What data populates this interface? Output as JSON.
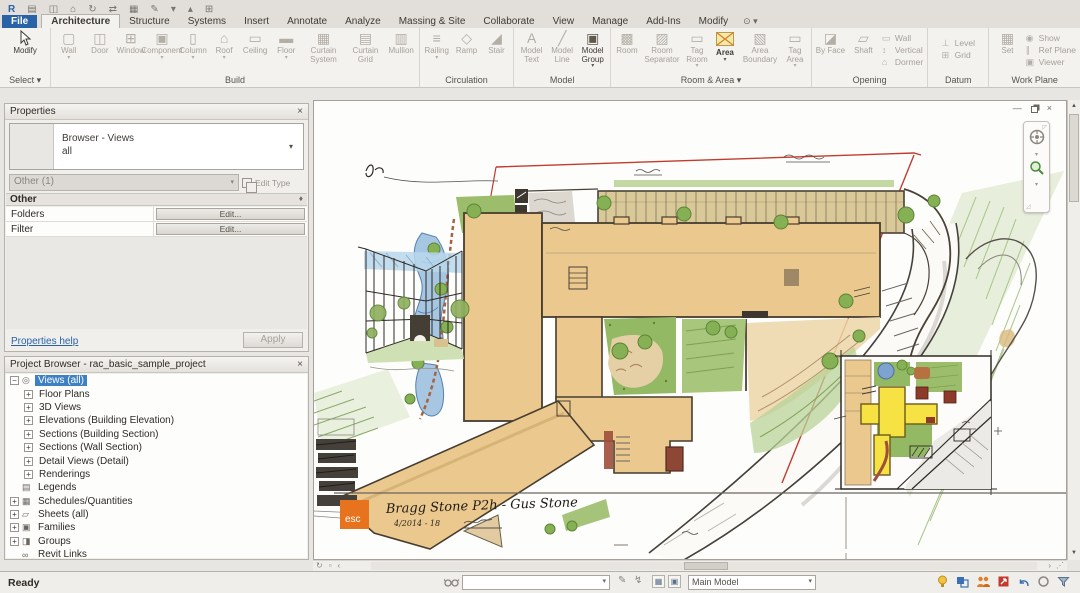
{
  "qat": {
    "glyphs": [
      "R",
      "▤",
      "◫",
      "⌂",
      "↻",
      "⇄",
      "▦",
      "✎",
      "▾",
      "▴",
      "⊞"
    ]
  },
  "tabs": {
    "items": [
      "File",
      "Architecture",
      "Structure",
      "Systems",
      "Insert",
      "Annotate",
      "Analyze",
      "Massing & Site",
      "Collaborate",
      "View",
      "Manage",
      "Add-Ins",
      "Modify"
    ],
    "modify_menu_icon": "⊙ ▾"
  },
  "ribbon": {
    "panels": [
      {
        "label": "Select ▾",
        "buttons": [
          {
            "label": "Modify",
            "enabled": true
          }
        ]
      },
      {
        "label": "Build",
        "buttons": [
          {
            "label": "Wall",
            "glyph": "▢",
            "arrow": "▾"
          },
          {
            "label": "Door",
            "glyph": "◫"
          },
          {
            "label": "Window",
            "glyph": "⊞"
          },
          {
            "label": "Component",
            "glyph": "▣",
            "arrow": "▾"
          },
          {
            "label": "Column",
            "glyph": "▯",
            "arrow": "▾"
          },
          {
            "label": "Roof",
            "glyph": "⌂",
            "arrow": "▾"
          },
          {
            "label": "Ceiling",
            "glyph": "▭"
          },
          {
            "label": "Floor",
            "glyph": "▬",
            "arrow": "▾"
          },
          {
            "label": "Curtain System",
            "glyph": "▦"
          },
          {
            "label": "Curtain Grid",
            "glyph": "▤"
          },
          {
            "label": "Mullion",
            "glyph": "▥"
          }
        ]
      },
      {
        "label": "Circulation",
        "buttons": [
          {
            "label": "Railing",
            "glyph": "≡",
            "arrow": "▾"
          },
          {
            "label": "Ramp",
            "glyph": "◇"
          },
          {
            "label": "Stair",
            "glyph": "◢"
          }
        ]
      },
      {
        "label": "Model",
        "buttons": [
          {
            "label": "Model Text",
            "glyph": "A"
          },
          {
            "label": "Model Line",
            "glyph": "╱"
          },
          {
            "label": "Model Group",
            "glyph": "▣",
            "arrow": "▾",
            "enabled": true
          }
        ]
      },
      {
        "label": "Room & Area ▾",
        "buttons": [
          {
            "label": "Room",
            "glyph": "▩"
          },
          {
            "label": "Room Separator",
            "glyph": "▨"
          },
          {
            "label": "Tag Room",
            "glyph": "▭",
            "arrow": "▾"
          },
          {
            "label": "Area",
            "glyph": "area",
            "arrow": "▾",
            "enabled": true,
            "highlight": true
          },
          {
            "label": "Area Boundary",
            "glyph": "▧"
          },
          {
            "label": "Tag Area",
            "glyph": "▭",
            "arrow": "▾"
          }
        ]
      },
      {
        "label": "Opening",
        "buttons": [
          {
            "label": "By Face",
            "glyph": "◪"
          },
          {
            "label": "Shaft",
            "glyph": "▱"
          }
        ],
        "small_buttons": [
          {
            "label": "Wall",
            "glyph": "▭"
          },
          {
            "label": "Vertical",
            "glyph": "↕"
          },
          {
            "label": "Dormer",
            "glyph": "⌂"
          }
        ]
      },
      {
        "label": "Datum",
        "small_buttons": [
          {
            "label": "Level",
            "glyph": "⊥"
          },
          {
            "label": "Grid",
            "glyph": "⊞"
          }
        ]
      },
      {
        "label": "Work Plane",
        "buttons": [
          {
            "label": "Set",
            "glyph": "▦"
          }
        ],
        "small_buttons": [
          {
            "label": "Show",
            "glyph": "◉"
          },
          {
            "label": "Ref Plane",
            "glyph": "∥"
          },
          {
            "label": "Viewer",
            "glyph": "▣"
          }
        ]
      }
    ]
  },
  "properties": {
    "title": "Properties",
    "close": "×",
    "type_name": "Browser - Views",
    "type_instance": "all",
    "type_dropdown": "▾",
    "selector_value": "Other (1)",
    "selector_caret": "▾",
    "edit_type_label": "Edit Type",
    "group_label": "Other",
    "pin": "♦",
    "rows": [
      {
        "label": "Folders",
        "button": "Edit..."
      },
      {
        "label": "Filter",
        "button": "Edit..."
      }
    ],
    "help_link": "Properties help",
    "apply_label": "Apply"
  },
  "project_browser": {
    "title": "Project Browser - rac_basic_sample_project",
    "close": "×",
    "items": [
      {
        "label": "Views (all)",
        "expander": "−",
        "icon": "◎",
        "selected": true
      },
      {
        "label": "Floor Plans",
        "expander": "+"
      },
      {
        "label": "3D Views",
        "expander": "+"
      },
      {
        "label": "Elevations (Building Elevation)",
        "expander": "+"
      },
      {
        "label": "Sections (Building Section)",
        "expander": "+"
      },
      {
        "label": "Sections (Wall Section)",
        "expander": "+"
      },
      {
        "label": "Detail Views (Detail)",
        "expander": "+"
      },
      {
        "label": "Renderings",
        "expander": "+"
      },
      {
        "label": "Legends",
        "icon": "▤"
      },
      {
        "label": "Schedules/Quantities",
        "expander": "+",
        "icon": "▦"
      },
      {
        "label": "Sheets (all)",
        "expander": "+",
        "icon": "▱"
      },
      {
        "label": "Families",
        "expander": "+",
        "icon": "▣"
      },
      {
        "label": "Groups",
        "expander": "+",
        "icon": "◨"
      },
      {
        "label": "Revit Links",
        "icon": "∞"
      }
    ]
  },
  "canvas": {
    "window_controls": {
      "minimize": "—",
      "close": "×"
    },
    "titleblock": {
      "logo": "esc",
      "title": "Bragg Stone P2h - Gus Stone",
      "subtitle": "4/2014 - 18"
    }
  },
  "view_bar": {
    "glyphs": [
      "↻",
      "▫",
      "‹"
    ]
  },
  "scroll": {
    "up": "▲",
    "down": "▼",
    "right": "›",
    "grip": "⋰"
  },
  "status_bar": {
    "ready": "Ready",
    "selection_combo": "",
    "main_model": "Main Model",
    "pencil": "✎",
    "bolt": "↯"
  },
  "colors": {
    "accent_blue": "#2a62a8",
    "highlight_yellow": "#f6e8a5",
    "selection_blue": "#3d80c4",
    "logo_orange": "#e8731e",
    "boundary_red": "#c23b2e",
    "building_tan": "#ebc88d"
  }
}
